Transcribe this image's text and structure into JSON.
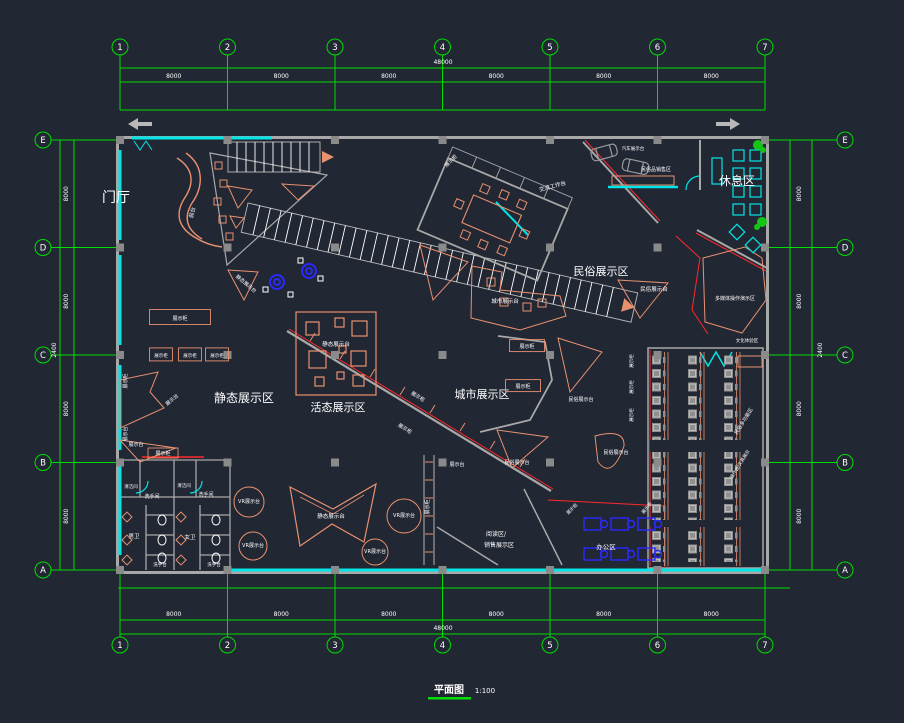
{
  "drawing": {
    "title": "平面图",
    "scale": "1:100",
    "colors": {
      "background": "#222734",
      "grid_green": "#00dd00",
      "wall_gray": "#a8a8a8",
      "furniture_salmon": "#e8916f",
      "glass_cyan": "#00e5e5",
      "accent_red": "#ff2a2a",
      "accent_blue": "#2a2aff",
      "text_white": "#ffffff",
      "plant_green": "#15c515",
      "column_gray": "#8a8a8a"
    }
  },
  "grid": {
    "columns": [
      {
        "label": "1",
        "x": 120
      },
      {
        "label": "2",
        "x": 227.5
      },
      {
        "label": "3",
        "x": 335
      },
      {
        "label": "4",
        "x": 442.5
      },
      {
        "label": "5",
        "x": 550
      },
      {
        "label": "6",
        "x": 657.5
      },
      {
        "label": "7",
        "x": 765
      }
    ],
    "rows": [
      {
        "label": "E",
        "y": 140
      },
      {
        "label": "D",
        "y": 247.5
      },
      {
        "label": "C",
        "y": 355
      },
      {
        "label": "B",
        "y": 462.5
      },
      {
        "label": "A",
        "y": 570
      }
    ]
  },
  "dims": {
    "top_segments": [
      "8000",
      "8000",
      "8000",
      "8000",
      "8000",
      "8000"
    ],
    "bottom_segments": [
      "8000",
      "8000",
      "8000",
      "8000",
      "8000",
      "8000"
    ],
    "left_segments": [
      "8000",
      "8000",
      "8000",
      "8000"
    ],
    "right_segments": [
      "8000",
      "8000",
      "8000",
      "8000"
    ],
    "total_width": "48000",
    "extra_dim": "2400"
  },
  "labels": [
    {
      "t": "门厅",
      "x": 116,
      "y": 202,
      "s": 14
    },
    {
      "t": "休息区",
      "x": 737,
      "y": 185,
      "s": 12
    },
    {
      "t": "民俗展示区",
      "x": 601,
      "y": 275,
      "s": 11
    },
    {
      "t": "静态展示区",
      "x": 244,
      "y": 402,
      "s": 12
    },
    {
      "t": "活态展示区",
      "x": 338,
      "y": 411,
      "s": 11
    },
    {
      "t": "城市展示区",
      "x": 482,
      "y": 398,
      "s": 11
    },
    {
      "t": "办公区",
      "x": 606,
      "y": 549,
      "s": 6.5
    },
    {
      "t": "阅读区/",
      "x": 496,
      "y": 536,
      "s": 6
    },
    {
      "t": "销售展示区",
      "x": 499,
      "y": 547,
      "s": 6
    },
    {
      "t": "前台",
      "x": 194,
      "y": 213,
      "s": 5.5,
      "r": -75
    },
    {
      "t": "展示柜",
      "x": 180,
      "y": 320,
      "s": 5,
      "bw": 61,
      "bh": 15
    },
    {
      "t": "展示柜",
      "x": 161,
      "y": 357,
      "s": 4.5,
      "bw": 23,
      "bh": 13
    },
    {
      "t": "展示柜",
      "x": 190,
      "y": 357,
      "s": 4.5,
      "bw": 23,
      "bh": 13
    },
    {
      "t": "展示柜",
      "x": 217,
      "y": 357,
      "s": 4.5,
      "bw": 23,
      "bh": 13
    },
    {
      "t": "展示台",
      "x": 173,
      "y": 401,
      "s": 5,
      "r": -40
    },
    {
      "t": "展示柜",
      "x": 127,
      "y": 381,
      "s": 5,
      "r": -90
    },
    {
      "t": "展示台",
      "x": 127,
      "y": 434,
      "s": 5,
      "r": -90
    },
    {
      "t": "静态展示台",
      "x": 245,
      "y": 285,
      "s": 5,
      "r": 40
    },
    {
      "t": "静态展示台",
      "x": 336,
      "y": 346,
      "s": 5.5
    },
    {
      "t": "展示柜",
      "x": 417,
      "y": 398,
      "s": 5,
      "r": 32
    },
    {
      "t": "展示柜",
      "x": 404,
      "y": 430,
      "s": 5,
      "r": 32
    },
    {
      "t": "静态展示台",
      "x": 331,
      "y": 518,
      "s": 5.5
    },
    {
      "t": "VR展示台",
      "x": 249,
      "y": 503,
      "s": 5
    },
    {
      "t": "VR展示台",
      "x": 253,
      "y": 547,
      "s": 5
    },
    {
      "t": "VR展示台",
      "x": 404,
      "y": 517,
      "s": 5
    },
    {
      "t": "VR展示台",
      "x": 375,
      "y": 553,
      "s": 5
    },
    {
      "t": "展示台",
      "x": 136,
      "y": 446,
      "s": 5
    },
    {
      "t": "展示柜",
      "x": 163,
      "y": 455,
      "s": 5,
      "bw": 30,
      "bh": 10
    },
    {
      "t": "清洁间",
      "x": 131,
      "y": 488,
      "s": 4.5
    },
    {
      "t": "洗手间",
      "x": 152,
      "y": 498,
      "s": 5
    },
    {
      "t": "清洁间",
      "x": 184,
      "y": 487,
      "s": 4.5
    },
    {
      "t": "洗手间",
      "x": 206,
      "y": 496,
      "s": 5
    },
    {
      "t": "男卫",
      "x": 134,
      "y": 538,
      "s": 5.5
    },
    {
      "t": "女卫",
      "x": 190,
      "y": 539,
      "s": 5.5
    },
    {
      "t": "洗手台",
      "x": 160,
      "y": 566,
      "s": 4.5
    },
    {
      "t": "洗手台",
      "x": 214,
      "y": 566,
      "s": 4.5
    },
    {
      "t": "展示柜",
      "x": 429,
      "y": 507,
      "s": 5,
      "r": -90
    },
    {
      "t": "展示台",
      "x": 457,
      "y": 466,
      "s": 5
    },
    {
      "t": "展示柜",
      "x": 527,
      "y": 348,
      "s": 5,
      "bw": 35,
      "bh": 12
    },
    {
      "t": "展示柜",
      "x": 523,
      "y": 388,
      "s": 5,
      "bw": 35,
      "bh": 12
    },
    {
      "t": "城市展示台",
      "x": 505,
      "y": 303,
      "s": 5.5
    },
    {
      "t": "民俗展示台",
      "x": 654,
      "y": 291,
      "s": 5.5
    },
    {
      "t": "民俗展示台",
      "x": 581,
      "y": 401,
      "s": 5
    },
    {
      "t": "民俗展示台",
      "x": 616,
      "y": 454,
      "s": 5
    },
    {
      "t": "民俗展示台",
      "x": 517,
      "y": 464,
      "s": 5
    },
    {
      "t": "展示柜",
      "x": 452,
      "y": 162,
      "s": 5,
      "r": -45
    },
    {
      "t": "汽车展示台",
      "x": 633,
      "y": 150,
      "s": 4.5
    },
    {
      "t": "民俗品销售区",
      "x": 656,
      "y": 171,
      "s": 5
    },
    {
      "t": "交流工作台",
      "x": 553,
      "y": 188,
      "s": 5.5,
      "r": -15
    },
    {
      "t": "多媒体操作演示区",
      "x": 735,
      "y": 300,
      "s": 5
    },
    {
      "t": "文化体验区",
      "x": 747,
      "y": 342,
      "s": 4.5
    },
    {
      "t": "民俗多功能区",
      "x": 745,
      "y": 422,
      "s": 5,
      "r": -58
    },
    {
      "t": "操作台/文具展示",
      "x": 741,
      "y": 465,
      "s": 4.5,
      "r": -58
    },
    {
      "t": "展示柜",
      "x": 633,
      "y": 361,
      "s": 4.5,
      "r": -90
    },
    {
      "t": "展示柜",
      "x": 633,
      "y": 387,
      "s": 4.5,
      "r": -90
    },
    {
      "t": "展示柜",
      "x": 633,
      "y": 415,
      "s": 4.5,
      "r": -90
    },
    {
      "t": "展示柜",
      "x": 648,
      "y": 509,
      "s": 4.5,
      "r": -50
    },
    {
      "t": "展示柜",
      "x": 573,
      "y": 510,
      "s": 4.5,
      "r": -45
    }
  ]
}
